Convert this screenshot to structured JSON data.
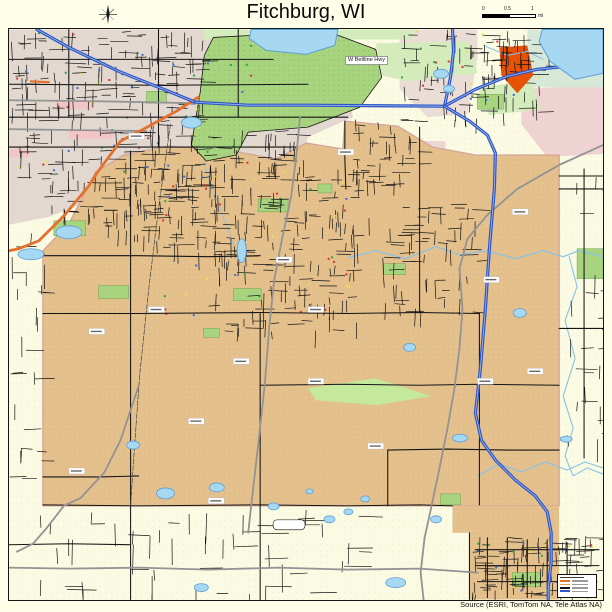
{
  "header": {
    "title": "Fitchburg, WI"
  },
  "icons": {
    "compass": "compass-rose-icon"
  },
  "scalebar": {
    "labels": [
      "0",
      "0.5",
      "1"
    ],
    "unit": "mi"
  },
  "map": {
    "beltline_label": "W Beltline Hwy"
  },
  "legend": {
    "rows": [
      "#3a3a3a",
      "#E4712E",
      "#E89A3C",
      "#141414",
      "#2E56C4"
    ]
  },
  "footer": {
    "attribution": "Source (ESRI, TomTom NA, Tele Atlas NA)"
  },
  "palette": {
    "page_bg": "#FFFFE9",
    "map_cream": "#FBFAE3",
    "urban_gray": "#E2D8D0",
    "urban_gray2": "#EADDD6",
    "urban_pink": "#F2C6C6",
    "city_tan": "#E4C08D",
    "tan_dot": "#CE9F66",
    "oregon_tan": "#DFB27F",
    "green_park": "#A9D47F",
    "green_mint": "#D4EBBC",
    "green_dot": "#79B452",
    "green_light": "#C4E89C",
    "marsh": "#D8E8D8",
    "water": "#A6D8F2",
    "water_edge": "#5C9FD6",
    "stream": "#86C2EA",
    "hwy_blue": "#2E56C4",
    "hwy_center": "#9FB8F0",
    "road_orange": "#E4712E",
    "road_gray": "#939393",
    "road_black": "#141414",
    "rail": "#444444",
    "boundary_pink": "#D4A89A",
    "hot_orange": "#E85207",
    "poi_red": "#E03030",
    "poi_green": "#2FA336",
    "poi_blue": "#3B6FD4",
    "poi_yellow": "#EFE04A"
  }
}
